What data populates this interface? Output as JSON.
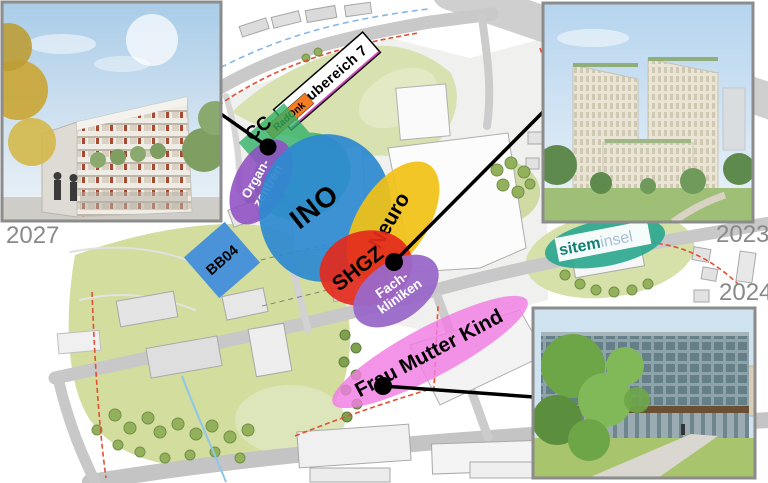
{
  "figure": {
    "years": {
      "top_left": "2027",
      "top_right": "2023",
      "bottom_right": "2024"
    }
  },
  "map": {
    "labels": {
      "baubereich": "Baubereich 7",
      "radonk": "RadOnk",
      "cc": "CC",
      "organ_line1": "Organ-",
      "organ_line2": "zentren",
      "ino": "INO",
      "neuro": "Neuro",
      "shgz": "SHGZ",
      "fach_line1": "Fach-",
      "fach_line2": "kliniken",
      "fmk": "Frau Mutter Kind",
      "bb04": "BB04",
      "sitem_brand1": "sitem",
      "sitem_brand2": "insel"
    },
    "colors": {
      "cc_green": "#2eb165",
      "organ_purple": "#8f4fc4",
      "ino_blue": "#2d8ad0",
      "neuro_yellow": "#f2c115",
      "shgz_red": "#e42a1d",
      "fach_purple": "#9a67c9",
      "fmk_pink": "#f17ce4",
      "bb04_blue": "#4b93d8",
      "sitem_teal": "#2ca78f",
      "radonk_orange": "#f57d20",
      "sitem_text_teal": "#0f7f6f",
      "sitem_text_gray": "#a8bfd4"
    }
  }
}
